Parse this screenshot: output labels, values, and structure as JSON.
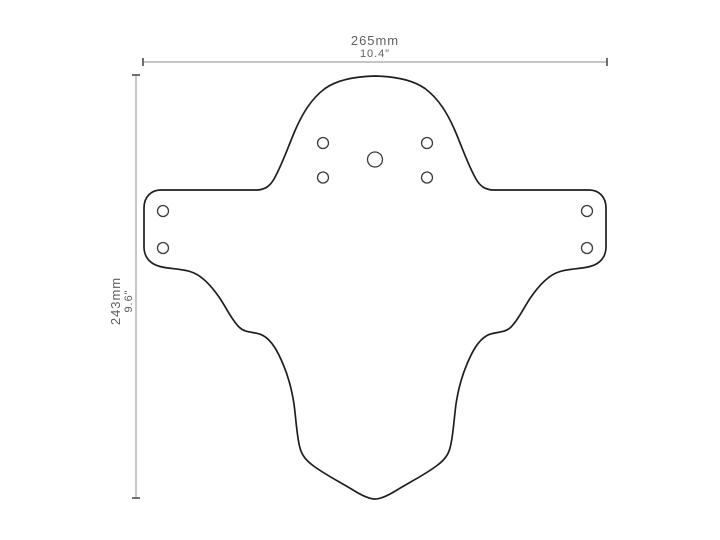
{
  "drawing": {
    "subject": "mudguard-dimension-drawing",
    "dimensions": {
      "width": {
        "metric": "265mm",
        "imperial": "10.4\""
      },
      "height": {
        "metric": "243mm",
        "imperial": "9.6\""
      }
    },
    "colors": {
      "outline": "#1f1f1f",
      "hole": "#3c3c3c",
      "dimension": "#8c8c8c",
      "tick": "#6f6f6f",
      "label": "#5f5f5f",
      "background": "#ffffff"
    }
  }
}
